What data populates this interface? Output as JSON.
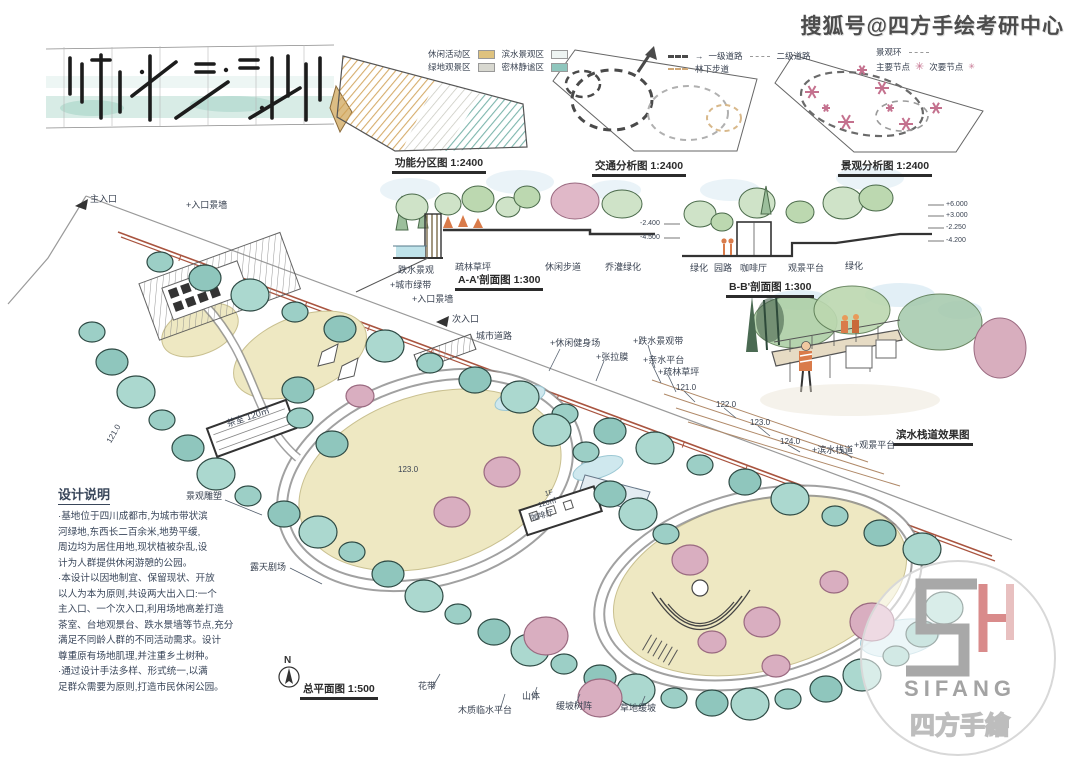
{
  "watermark": {
    "text": "搜狐号@四方手绘考研中心"
  },
  "colors": {
    "boundary": "#a9543f",
    "tree_teal": "#8fc6bd",
    "tree_dark": "#2e4a44",
    "lawn": "#eee8c2",
    "pink_tree": "#d9aec0",
    "water": "#cfe8ee",
    "ink": "#39465a",
    "brand_gray": "#a3a3a3",
    "brand_red": "#d98b8b"
  },
  "diagrams": {
    "function": {
      "caption": "功能分区图 1:2400",
      "legend": [
        {
          "label": "休闲活动区",
          "color": "#dec27e"
        },
        {
          "label": "滨水景观区",
          "color": "#eef4f2"
        },
        {
          "label": "绿地观景区",
          "color": "#d8d8d0"
        },
        {
          "label": "密林静谧区",
          "color": "#8fc6bd"
        }
      ]
    },
    "traffic": {
      "caption": "交通分析图 1:2400",
      "legend": [
        {
          "label": "一级道路"
        },
        {
          "label": "二级道路"
        },
        {
          "label": "林下步道"
        }
      ]
    },
    "scenery": {
      "caption": "景观分析图 1:2400",
      "legend": [
        {
          "label": "景观环"
        },
        {
          "label": "主要节点"
        },
        {
          "label": "次要节点"
        }
      ]
    }
  },
  "sections": {
    "aa": {
      "caption": "A-A'剖面图 1:300",
      "labels": [
        "跌水景观",
        "疏林草坪",
        "休闲步道",
        "乔灌绿化"
      ]
    },
    "bb": {
      "caption": "B-B'剖面图 1:300",
      "labels": [
        "绿化",
        "园路",
        "咖啡厅",
        "观景平台",
        "绿化"
      ],
      "elev_left": [
        "-2.400",
        "-4.500"
      ],
      "elev_right": [
        "+6.000",
        "+3.000",
        "-2.250",
        "-4.200"
      ]
    }
  },
  "perspective": {
    "caption": "滨水栈道效果图"
  },
  "plan": {
    "caption": "总平面图 1:500",
    "north": "N",
    "labels": [
      {
        "text": "主入口"
      },
      {
        "text": "+入口景墙"
      },
      {
        "text": "+城市绿带"
      },
      {
        "text": "+入口景墙"
      },
      {
        "text": "次入口"
      },
      {
        "text": "城市道路"
      },
      {
        "text": "+休闲健身场"
      },
      {
        "text": "+张拉膜"
      },
      {
        "text": "+跌水景观带"
      },
      {
        "text": "+亲水平台"
      },
      {
        "text": "+疏林草坪"
      },
      {
        "text": "121.0"
      },
      {
        "text": "122.0"
      },
      {
        "text": "123.0"
      },
      {
        "text": "124.0"
      },
      {
        "text": "+滨水栈道"
      },
      {
        "text": "+观景平台"
      },
      {
        "text": "景观雕塑"
      },
      {
        "text": "露天剧场"
      },
      {
        "text": "茶室 120㎡"
      },
      {
        "text": "1F"
      },
      {
        "text": "120㎡"
      },
      {
        "text": "咖啡厅"
      },
      {
        "text": "123.0"
      },
      {
        "text": "121.0"
      },
      {
        "text": "花带"
      },
      {
        "text": "木质临水平台"
      },
      {
        "text": "山体"
      },
      {
        "text": "缓坡树阵"
      },
      {
        "text": "草地缓坡"
      }
    ],
    "notes": {
      "title": "设计说明",
      "lines": [
        "·基地位于四川成都市,为城市带状滨",
        "河绿地,东西长二百余米,地势平缓,",
        "周边均为居住用地,现状植被杂乱,设",
        "计为人群提供休闲游憩的公园。",
        "·本设计以因地制宜、保留现状、开放",
        "以人为本为原则,共设两大出入口:一个",
        "主入口、一个次入口,利用场地高差打造",
        "茶室、台地观景台、跌水景墙等节点,充分",
        "满足不同龄人群的不同活动需求。设计",
        "尊重原有场地肌理,并注重乡土树种。",
        "·通过设计手法多样、形式统一,以满",
        "足群众需要为原则,打造市民休闲公园。"
      ]
    }
  },
  "logo": {
    "name": "SIFANG",
    "cn": "四方手繪"
  }
}
